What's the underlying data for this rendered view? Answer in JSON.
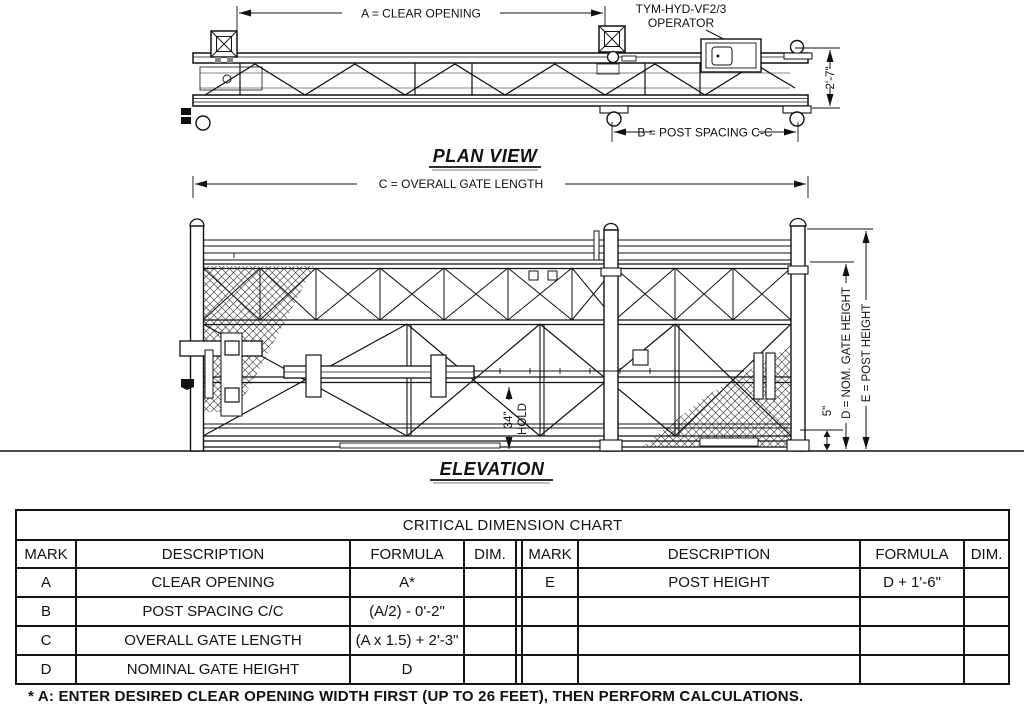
{
  "plan": {
    "title": "PLAN VIEW",
    "dim_clear_opening": "A = CLEAR OPENING",
    "operator_label_line1": "TYM-HYD-VF2/3",
    "operator_label_line2": "OPERATOR",
    "dim_beam_height": "2'-7\"",
    "dim_post_spacing": "B = POST SPACING C-C"
  },
  "elevation": {
    "title": "ELEVATION",
    "dim_overall_length": "C = OVERALL GATE LENGTH",
    "dim_nominal_gate_height": "D = NOM. GATE HEIGHT",
    "dim_post_height": "E = POST HEIGHT",
    "dim_ground_clearance": "5\"",
    "dim_hold_value": "34\"",
    "dim_hold_label": "HOLD"
  },
  "chart": {
    "title": "CRITICAL DIMENSION CHART",
    "headers": {
      "mark": "MARK",
      "description": "DESCRIPTION",
      "formula": "FORMULA",
      "dim": "DIM."
    },
    "rows_left": [
      {
        "mark": "A",
        "description": "CLEAR OPENING",
        "formula": "A*",
        "dim": ""
      },
      {
        "mark": "B",
        "description": "POST SPACING C/C",
        "formula": "(A/2) - 0'-2\"",
        "dim": ""
      },
      {
        "mark": "C",
        "description": "OVERALL GATE LENGTH",
        "formula": "(A x 1.5) + 2'-3\"",
        "dim": ""
      },
      {
        "mark": "D",
        "description": "NOMINAL GATE HEIGHT",
        "formula": "D",
        "dim": ""
      }
    ],
    "rows_right": [
      {
        "mark": "E",
        "description": "POST HEIGHT",
        "formula": "D + 1'-6\"",
        "dim": ""
      },
      {
        "mark": "",
        "description": "",
        "formula": "",
        "dim": ""
      },
      {
        "mark": "",
        "description": "",
        "formula": "",
        "dim": ""
      },
      {
        "mark": "",
        "description": "",
        "formula": "",
        "dim": ""
      }
    ]
  },
  "footnote": "* A: ENTER DESIRED CLEAR OPENING WIDTH FIRST (UP TO 26 FEET), THEN PERFORM CALCULATIONS.",
  "colors": {
    "line": "#111111",
    "background": "#ffffff"
  }
}
